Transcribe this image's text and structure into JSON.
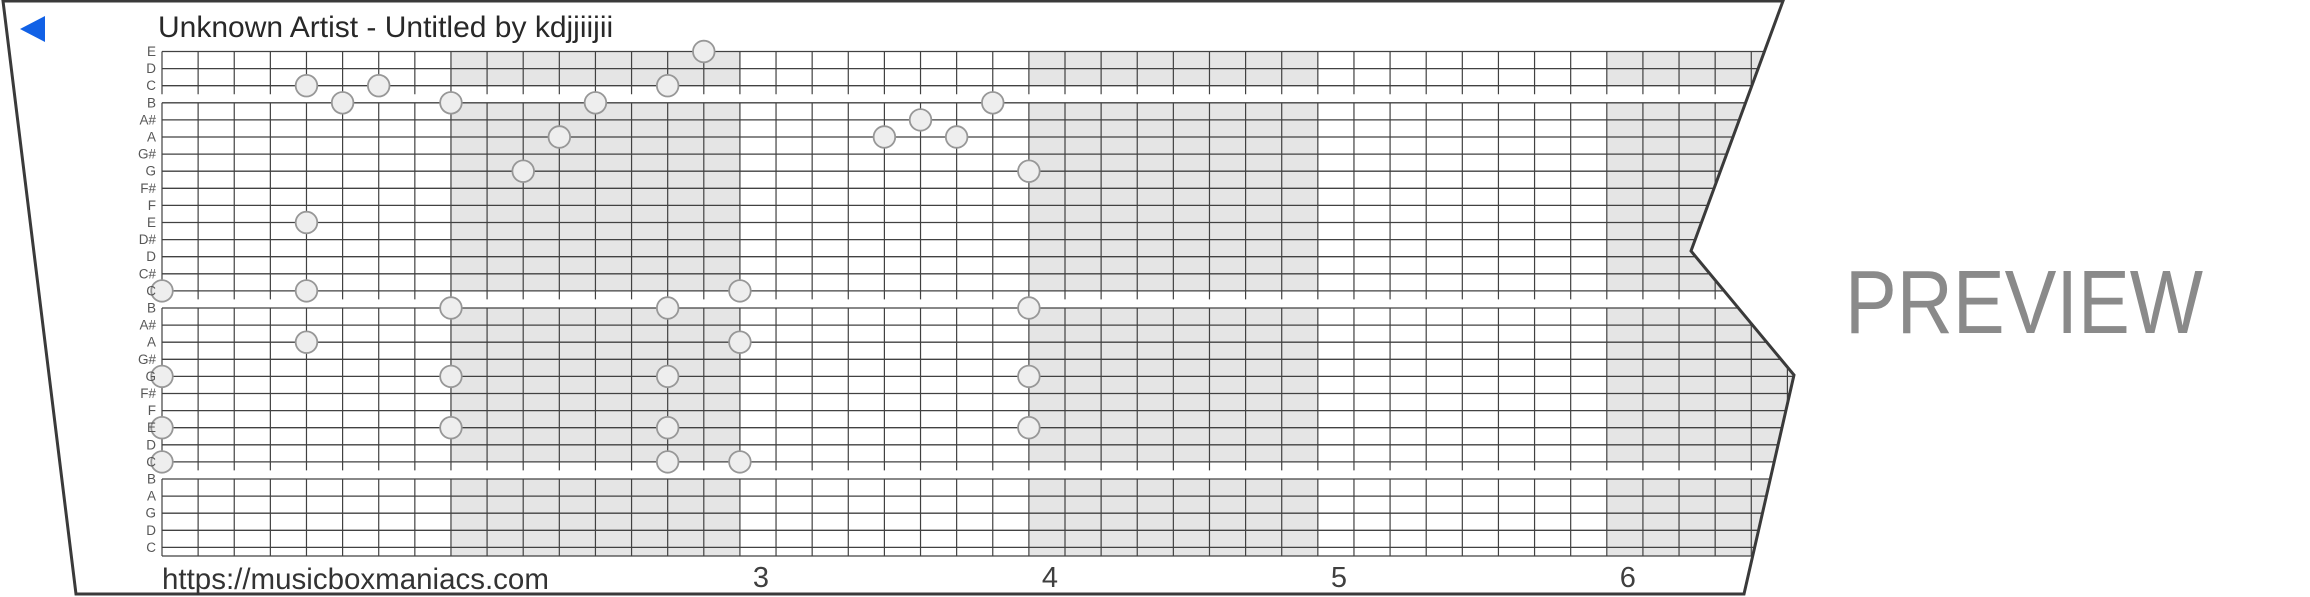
{
  "header": {
    "title": "Unknown Artist - Untitled by kdjjiijii"
  },
  "footer": {
    "url": "https://musicboxmaniacs.com",
    "measure_numbers": [
      "3",
      "4",
      "5",
      "6"
    ],
    "first_numbered_measure": 3
  },
  "watermark": "PREVIEW",
  "strip": {
    "row_labels": [
      "E",
      "D",
      "C",
      "B",
      "A#",
      "A",
      "G#",
      "G",
      "F#",
      "F",
      "E",
      "D#",
      "D",
      "C#",
      "C",
      "B",
      "A#",
      "A",
      "G#",
      "G",
      "F#",
      "F",
      "E",
      "D",
      "C",
      "B",
      "A",
      "G",
      "D",
      "C"
    ],
    "octave_breaks_after_rows": [
      2,
      14,
      24
    ],
    "shaded_measures": [
      2,
      4,
      6
    ],
    "columns_per_measure": 8,
    "notes": [
      {
        "row": 0,
        "col": 15
      },
      {
        "row": 2,
        "col": 4
      },
      {
        "row": 2,
        "col": 6
      },
      {
        "row": 2,
        "col": 14
      },
      {
        "row": 3,
        "col": 5
      },
      {
        "row": 3,
        "col": 8
      },
      {
        "row": 3,
        "col": 12
      },
      {
        "row": 3,
        "col": 23
      },
      {
        "row": 4,
        "col": 21
      },
      {
        "row": 5,
        "col": 11
      },
      {
        "row": 5,
        "col": 20
      },
      {
        "row": 5,
        "col": 22
      },
      {
        "row": 7,
        "col": 10
      },
      {
        "row": 7,
        "col": 24
      },
      {
        "row": 10,
        "col": 4
      },
      {
        "row": 14,
        "col": 0
      },
      {
        "row": 14,
        "col": 4
      },
      {
        "row": 14,
        "col": 16
      },
      {
        "row": 15,
        "col": 8
      },
      {
        "row": 15,
        "col": 14
      },
      {
        "row": 15,
        "col": 24
      },
      {
        "row": 17,
        "col": 4
      },
      {
        "row": 17,
        "col": 16
      },
      {
        "row": 19,
        "col": 0
      },
      {
        "row": 19,
        "col": 8
      },
      {
        "row": 19,
        "col": 14
      },
      {
        "row": 19,
        "col": 24
      },
      {
        "row": 22,
        "col": 0
      },
      {
        "row": 22,
        "col": 8
      },
      {
        "row": 22,
        "col": 14
      },
      {
        "row": 22,
        "col": 24
      },
      {
        "row": 24,
        "col": 0
      },
      {
        "row": 24,
        "col": 14
      },
      {
        "row": 24,
        "col": 16
      }
    ]
  },
  "colors": {
    "accent_blue": "#1161e6",
    "shading": "#e5e5e5",
    "grid_line": "#414141",
    "paper_border": "#3a3a3a",
    "note_fill": "#eeeeee",
    "note_stroke": "#979797",
    "label_gray": "#575757",
    "text_dark": "#2a2a2a",
    "watermark_gray": "#8a8a8a"
  }
}
